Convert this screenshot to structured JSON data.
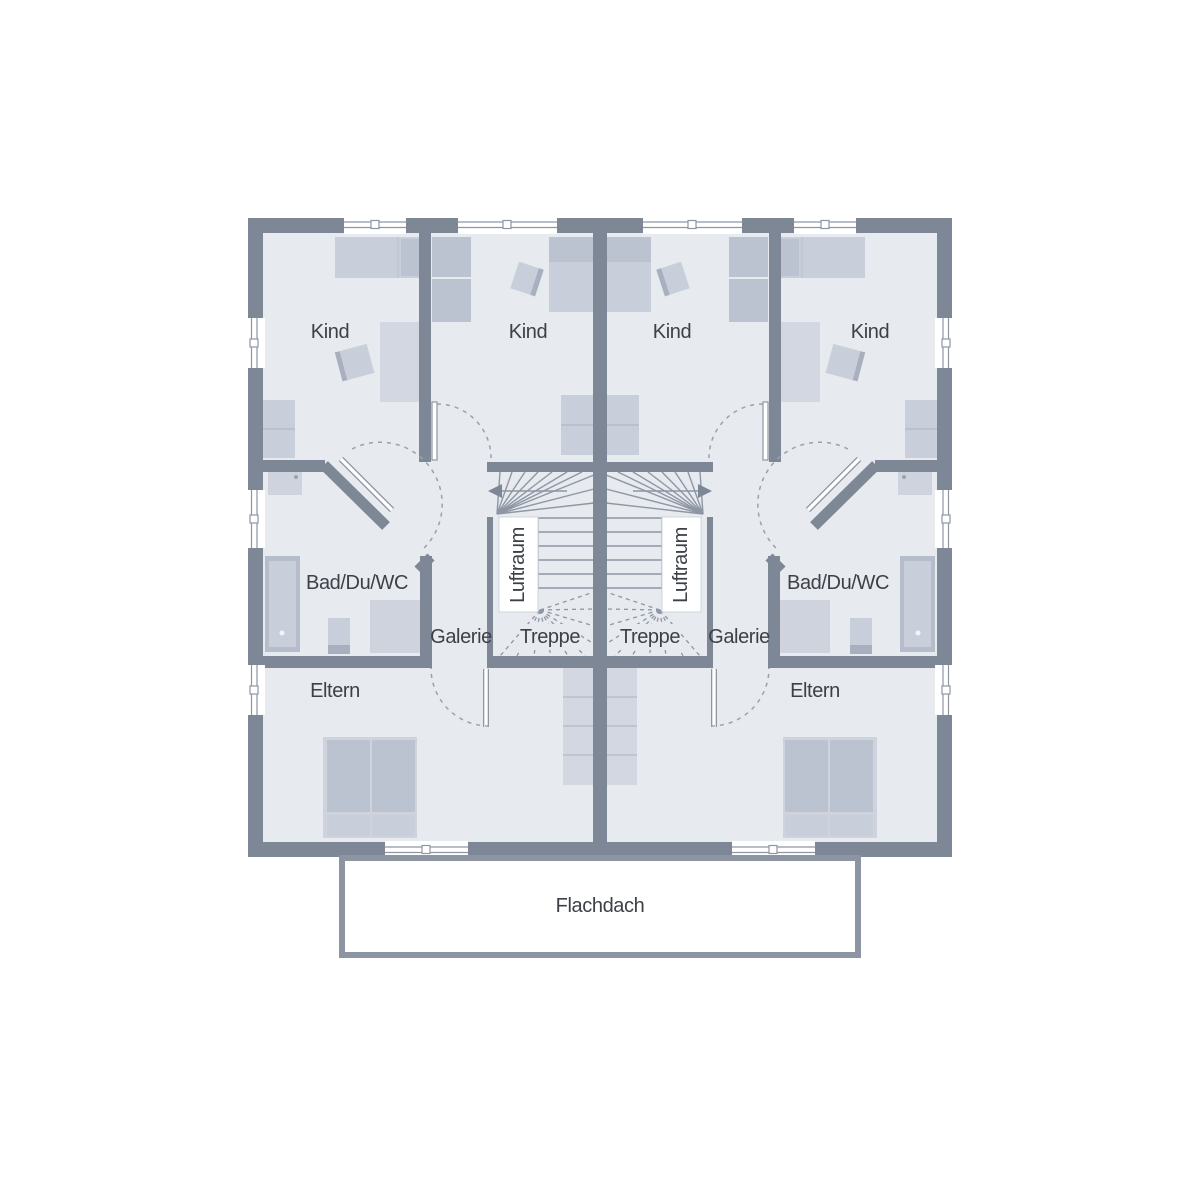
{
  "floor_plan": {
    "room_labels": {
      "kind": "Kind",
      "bad": "Bad/Du/WC",
      "galerie": "Galerie",
      "treppe": "Treppe",
      "luftraum": "Luftraum",
      "eltern": "Eltern"
    },
    "annotations": {
      "flachdach": "Flachdach"
    },
    "colors": {
      "background": "#ffffff",
      "wall": "#7e8795",
      "floor": "#e7eaef",
      "furniture_light": "#ced3dd",
      "furniture_medium": "#c9cfda",
      "furniture_dark": "#bbc2d0",
      "fixture_dark": "#b5bdcb",
      "line": "#8e96a3",
      "dashed_line": "#99a1ad",
      "text": "#3c4148",
      "roof_border": "#8c95a1"
    }
  }
}
